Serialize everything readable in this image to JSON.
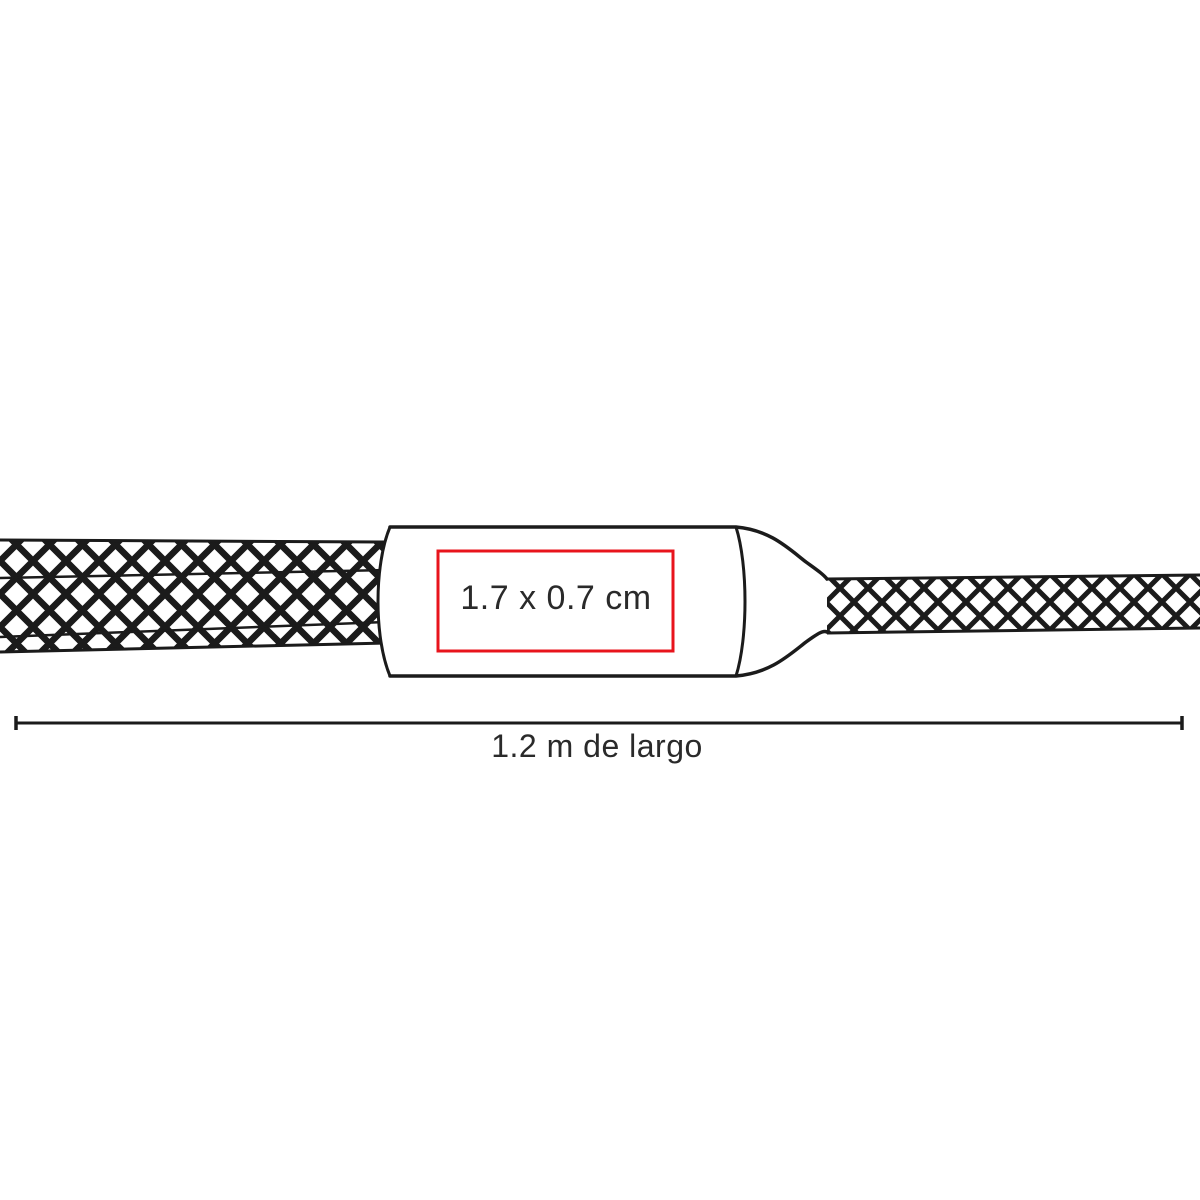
{
  "colors": {
    "background": "#ffffff",
    "line": "#1b1b1b",
    "print_area_red": "#e8141c",
    "text": "#2a2a2a"
  },
  "diagram": {
    "subject": "braided-cable-with-connector-body",
    "print_area": {
      "label": "1.7 x 0.7 cm"
    },
    "length_dimension": {
      "label": "1.2 m de largo"
    }
  }
}
